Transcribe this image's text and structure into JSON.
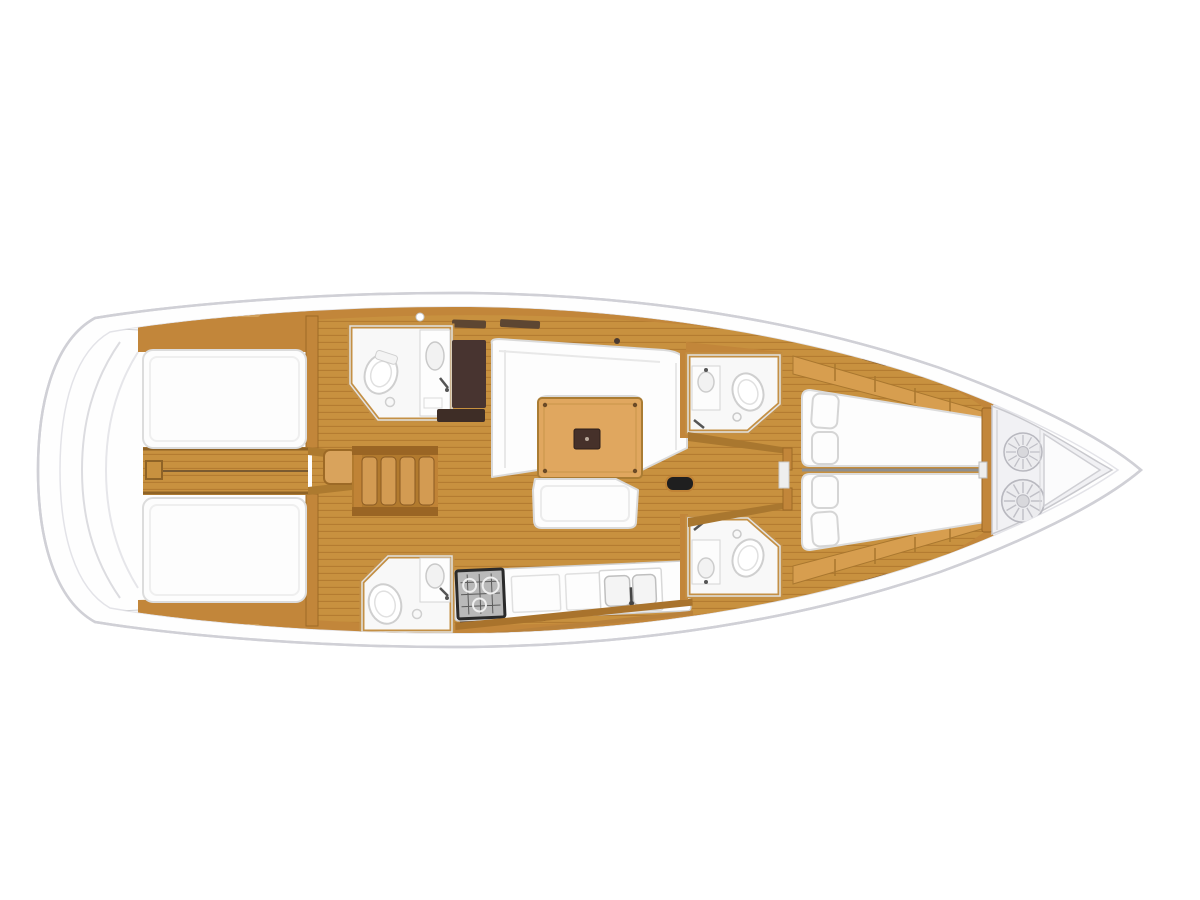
{
  "figure": {
    "type": "sailing-yacht-interior-floor-plan",
    "view": "top-down",
    "orientation": "bow-right",
    "visible_text": ""
  },
  "colors": {
    "background": "#ffffff",
    "hull_outline": "#d6d6db",
    "wood_furniture": "#c2863a",
    "wood_floor": "#c8913f",
    "wood_floor_stripe": "#b47c31",
    "wood_light": "#d9a35c",
    "wood_trim": "#9d6a26",
    "table_top": "#e0a75f",
    "dark_panel": "#483430",
    "upholstery_white": "#fdfdfd",
    "anchor_locker": "#f1f1f4",
    "stove": "#b9b9b9",
    "berth_centerline": "#8f8f8f"
  },
  "components": {
    "hull": [
      "hull-outline",
      "transom-steps",
      "side-deck-bands"
    ],
    "cabins": [
      "aft-cabin-port",
      "aft-cabin-starboard",
      "forward-v-berth"
    ],
    "heads": [
      "aft-head-port",
      "aft-head-starboard",
      "forward-head-port",
      "forward-head-starboard"
    ],
    "salon": [
      "u-shaped-settee",
      "saloon-table",
      "bench-seat",
      "pouf"
    ],
    "galley": [
      "stove",
      "double-sink",
      "counter-panels"
    ],
    "circulation": [
      "aft-corridor",
      "companionway-stairs",
      "forward-passage"
    ],
    "bow": [
      "anchor-locker",
      "rope-coil",
      "rope-coil",
      "bow-triangle"
    ],
    "fixtures_per_head": [
      "toilet",
      "washbasin",
      "faucet"
    ]
  }
}
